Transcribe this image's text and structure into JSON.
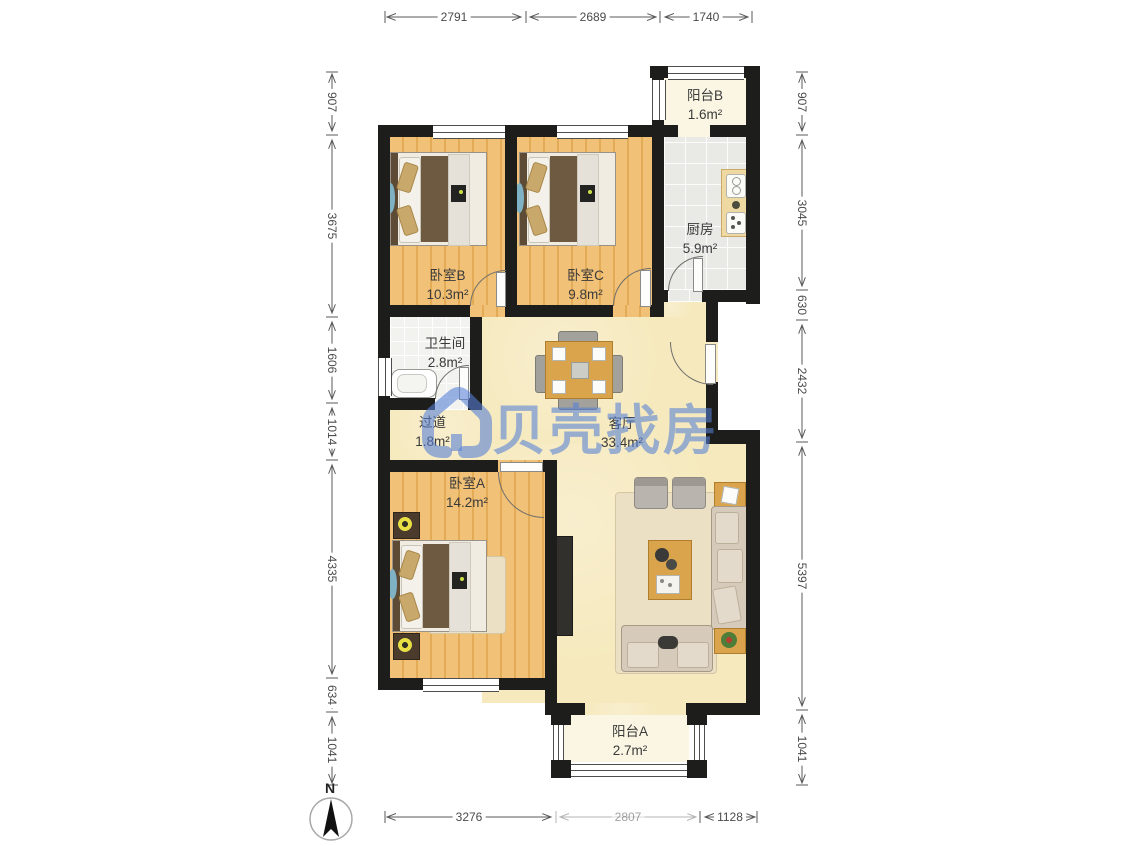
{
  "watermark": {
    "brand": "贝壳找房"
  },
  "compass": {
    "label": "N"
  },
  "rooms": [
    {
      "id": "bedroomB",
      "name": "卧室B",
      "area": "10.3m²"
    },
    {
      "id": "bedroomC",
      "name": "卧室C",
      "area": "9.8m²"
    },
    {
      "id": "balconyB",
      "name": "阳台B",
      "area": "1.6m²"
    },
    {
      "id": "kitchen",
      "name": "厨房",
      "area": "5.9m²"
    },
    {
      "id": "bathroom",
      "name": "卫生间",
      "area": "2.8m²"
    },
    {
      "id": "hallway",
      "name": "过道",
      "area": "1.8m²"
    },
    {
      "id": "living",
      "name": "客厅",
      "area": "33.4m²"
    },
    {
      "id": "bedroomA",
      "name": "卧室A",
      "area": "14.2m²"
    },
    {
      "id": "balconyA",
      "name": "阳台A",
      "area": "2.7m²"
    }
  ],
  "dimensions": {
    "top": [
      "2791",
      "2689",
      "1740"
    ],
    "bottom": [
      "3276",
      "2807",
      "1128"
    ],
    "left": [
      "907",
      "3675",
      "1606",
      "1014",
      "4335",
      "634",
      "1041"
    ],
    "right": [
      "907",
      "3045",
      "630",
      "2432",
      "5397",
      "1041"
    ]
  },
  "colors": {
    "watermark_blue": "#5580D6",
    "wall_black": "#1D1D1B",
    "wood_floor": "#EFBD70",
    "living_floor": "#F6E9BD",
    "tile_gray": "#E9E9E6",
    "balcony_cream": "#FAF6E3"
  }
}
